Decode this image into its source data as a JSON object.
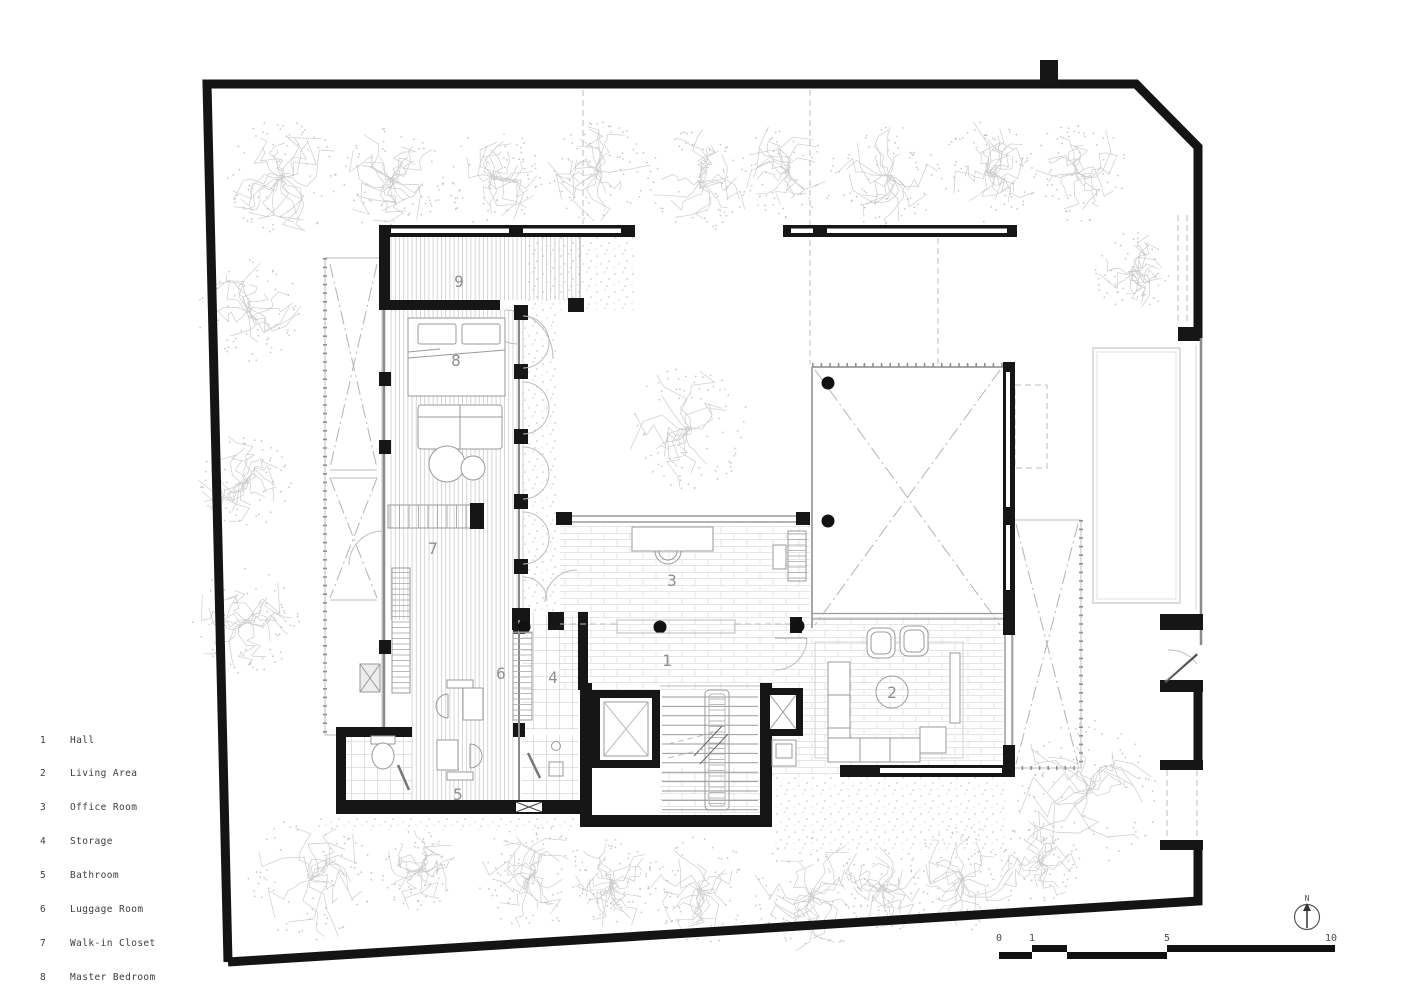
{
  "rooms": [
    {
      "number": "1",
      "name": "Hall"
    },
    {
      "number": "2",
      "name": "Living Area"
    },
    {
      "number": "3",
      "name": "Office Room"
    },
    {
      "number": "4",
      "name": "Storage"
    },
    {
      "number": "5",
      "name": "Bathroom"
    },
    {
      "number": "6",
      "name": "Luggage Room"
    },
    {
      "number": "7",
      "name": "Walk-in Closet"
    },
    {
      "number": "8",
      "name": "Master Bedroom"
    },
    {
      "number": "9",
      "name": "Storage"
    }
  ],
  "scale_bar": {
    "labels": [
      "0",
      "1",
      "5",
      "10"
    ]
  },
  "north": {
    "label": "N"
  },
  "colors": {
    "wall": "#161616",
    "light_line": "#bdbdbd",
    "label": "#8f8f8f",
    "text": "#3d3d3d"
  }
}
